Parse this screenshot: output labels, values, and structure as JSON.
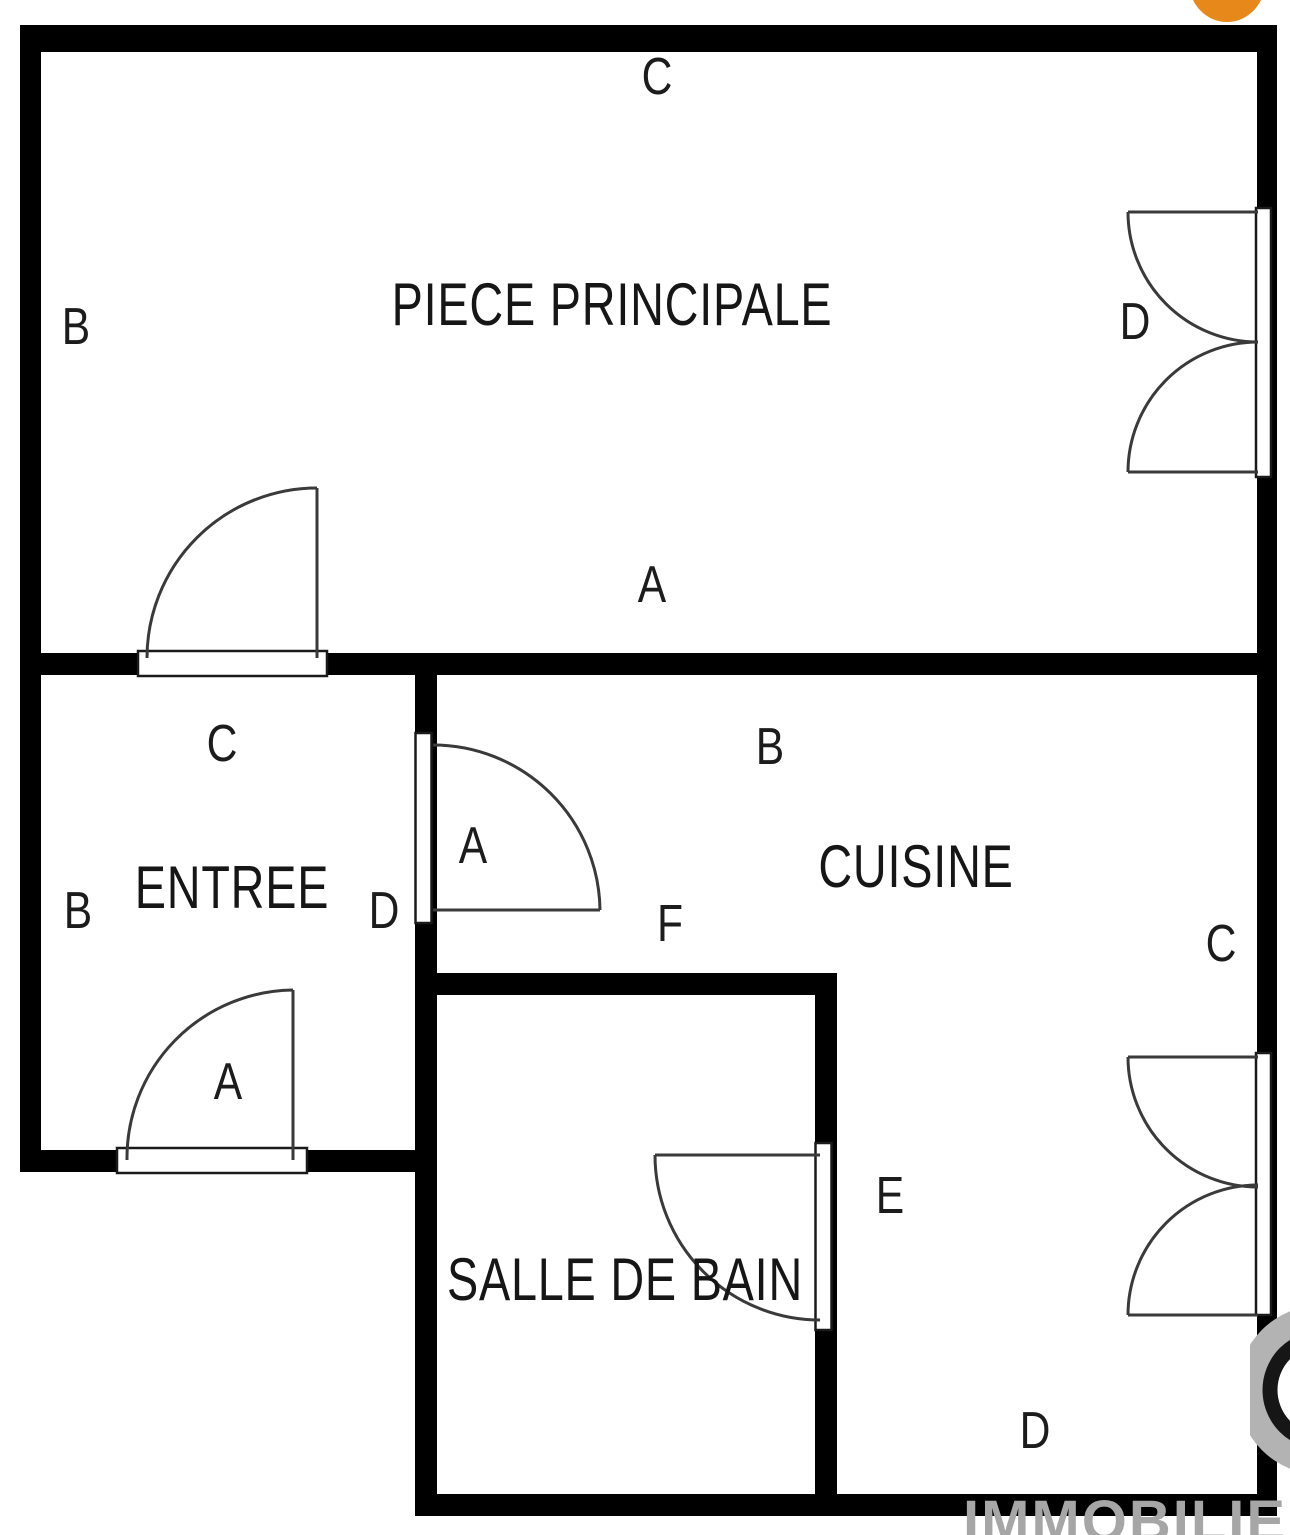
{
  "rooms": {
    "piece_principale": "PIECE PRINCIPALE",
    "entree": "ENTREE",
    "cuisine": "CUISINE",
    "salle_de_bain": "SALLE DE BAIN"
  },
  "labels": {
    "pp_top": "C",
    "pp_left": "B",
    "pp_right_door": "D",
    "pp_bottom": "A",
    "entree_top": "C",
    "entree_left": "B",
    "entree_right": "D",
    "cuisine_door": "A",
    "cuisine_top": "B",
    "cuisine_center": "F",
    "cuisine_right": "C",
    "entree_bottom_door": "A",
    "sdb_door": "E",
    "bottom_right_door": "D"
  },
  "watermark": {
    "text": "IMMOBILIER"
  },
  "colors": {
    "wall": "#000000",
    "door_line": "#3a3a3a",
    "accent_orange": "#e6891a",
    "watermark_gray": "#b3b3b3",
    "watermark_text_gray": "#a6a6a6"
  }
}
